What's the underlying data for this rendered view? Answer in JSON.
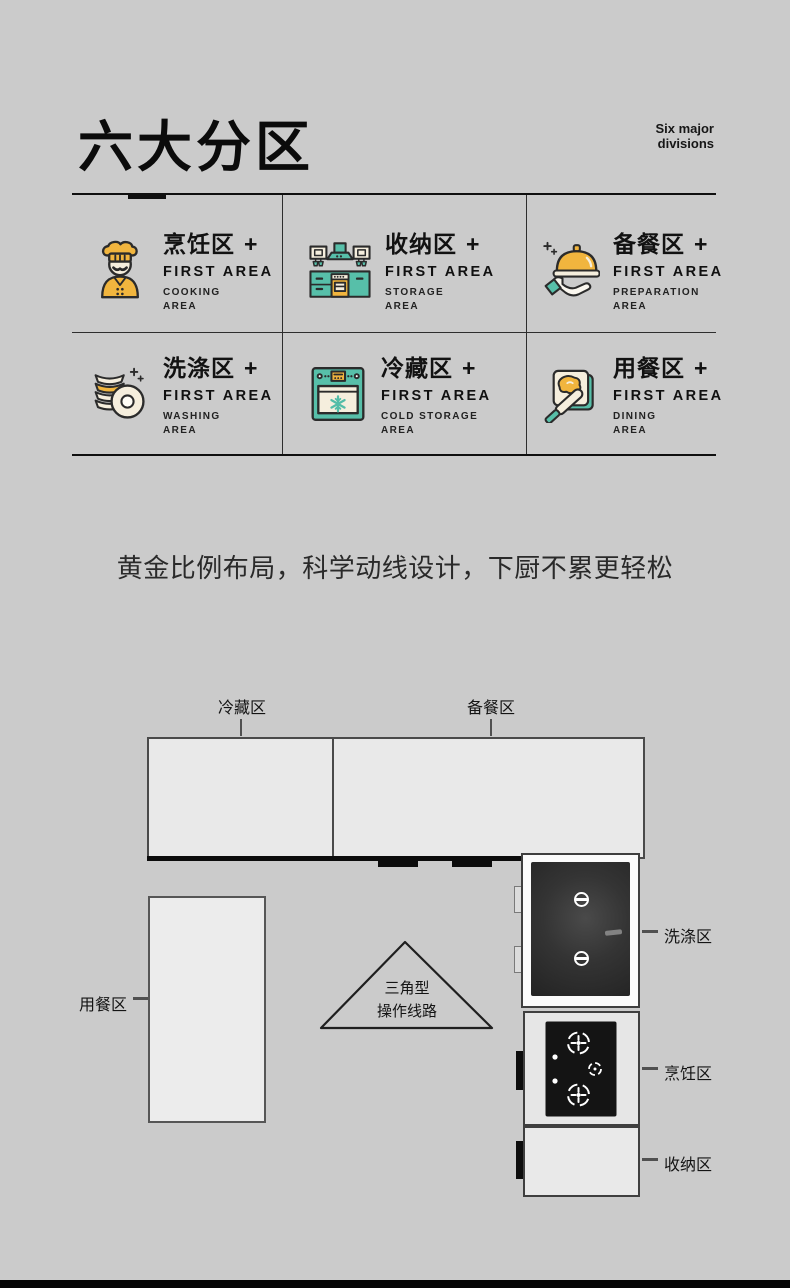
{
  "header": {
    "title": "六大分区",
    "subtitle_line1": "Six major",
    "subtitle_line2": "divisions"
  },
  "slogan": "黄金比例布局，科学动线设计，下厨不累更轻松",
  "zones": [
    {
      "name": "烹饪区",
      "plus": "+",
      "first_en": "FIRST AREA",
      "sub_en_1": "COOKING",
      "sub_en_2": "AREA",
      "icon": "chef-icon"
    },
    {
      "name": "收纳区",
      "plus": "+",
      "first_en": "FIRST AREA",
      "sub_en_1": "STORAGE",
      "sub_en_2": "AREA",
      "icon": "kitchen-cabinet-icon"
    },
    {
      "name": "备餐区",
      "plus": "+",
      "first_en": "FIRST AREA",
      "sub_en_1": "PREPARATION",
      "sub_en_2": "AREA",
      "icon": "cloche-hand-icon"
    },
    {
      "name": "洗涤区",
      "plus": "+",
      "first_en": "FIRST AREA",
      "sub_en_1": "WASHING",
      "sub_en_2": "AREA",
      "icon": "dish-stack-icon"
    },
    {
      "name": "冷藏区",
      "plus": "+",
      "first_en": "FIRST AREA",
      "sub_en_1": "COLD STORAGE",
      "sub_en_2": "AREA",
      "icon": "fridge-icon"
    },
    {
      "name": "用餐区",
      "plus": "+",
      "first_en": "FIRST AREA",
      "sub_en_1": "DINING",
      "sub_en_2": "AREA",
      "icon": "toast-knife-icon"
    }
  ],
  "floor_plan": {
    "top_labels": {
      "fridge": "冷藏区",
      "prep": "备餐区"
    },
    "right_labels": {
      "washing": "洗涤区",
      "cooking": "烹饪区",
      "storage": "收纳区"
    },
    "left_labels": {
      "dining": "用餐区"
    },
    "triangle": {
      "line1": "三角型",
      "line2": "操作线路"
    }
  },
  "colors": {
    "background": "#cbcbcb",
    "accent_yellow": "#F1B53E",
    "accent_teal": "#57BFA9",
    "cream": "#F5EEDD",
    "ink": "#111111"
  }
}
